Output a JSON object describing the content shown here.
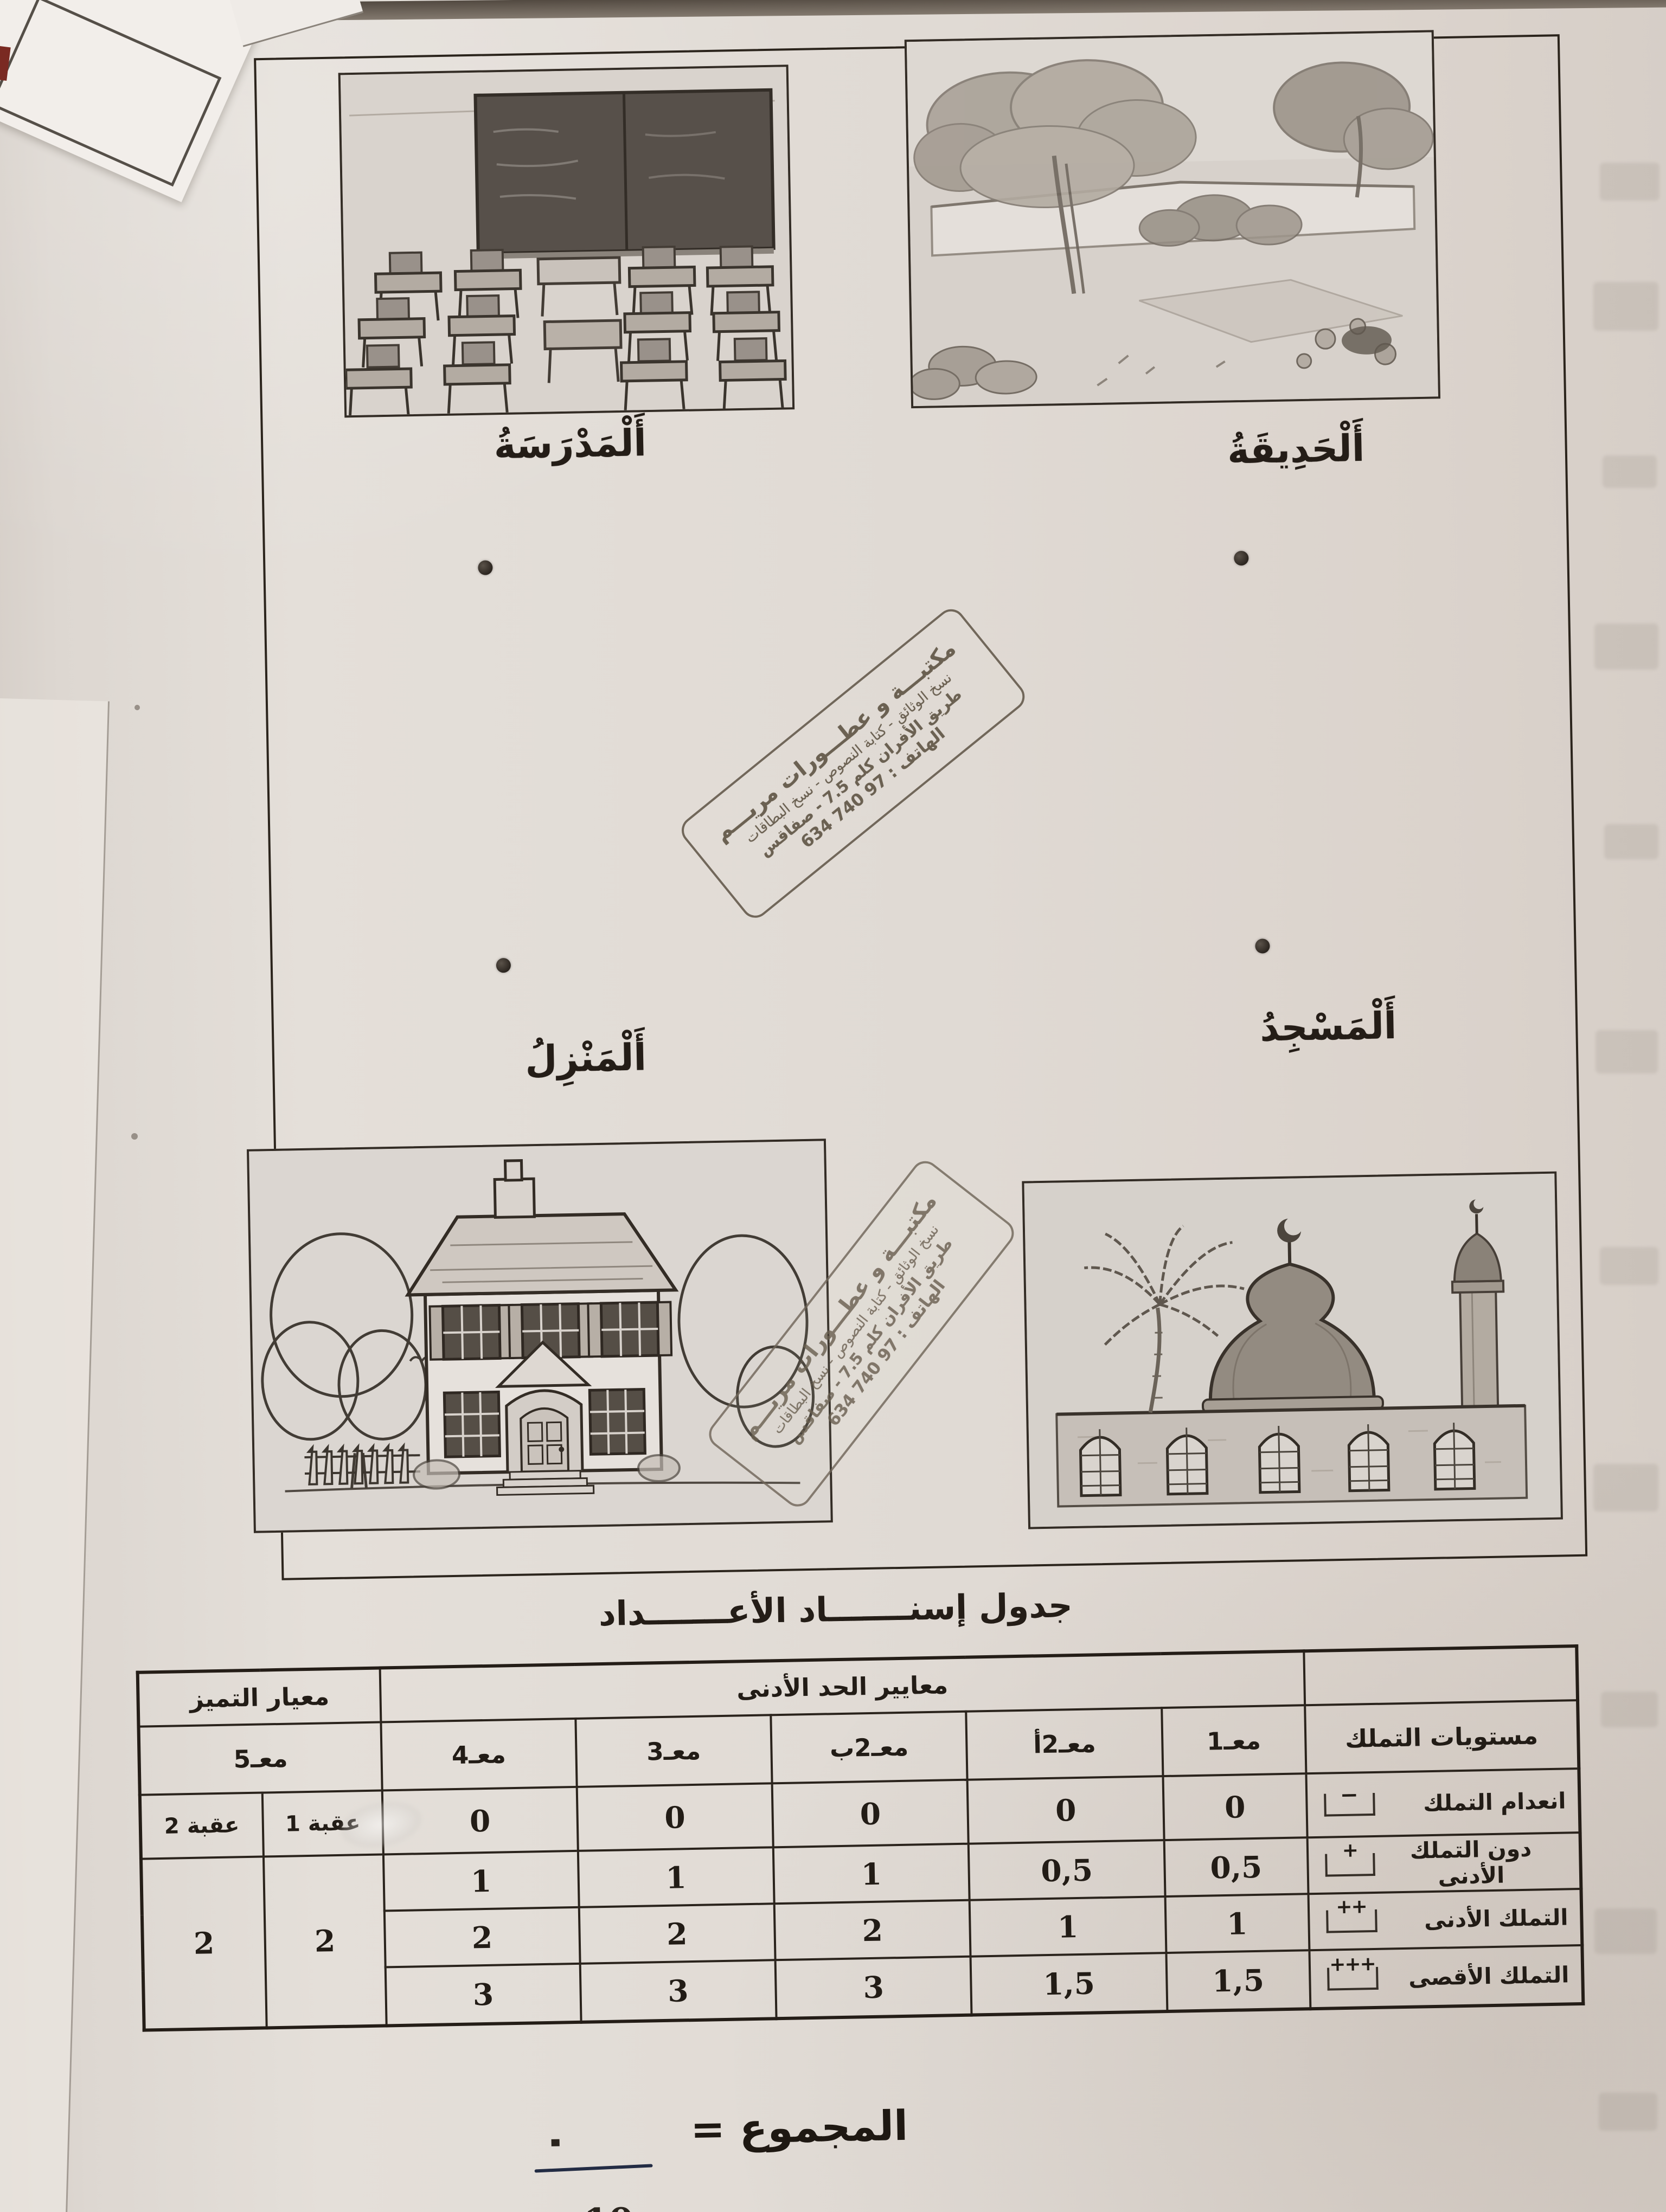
{
  "cards": {
    "school_label": "أَلْمَدْرَسَةُ",
    "garden_label": "أَلْحَدِيقَةُ",
    "house_label": "أَلْمَنْزِلُ",
    "mosque_label": "أَلْمَسْجِدُ"
  },
  "stamp": {
    "shop_name": "مكتبـــة و عطـــورات مريـــم",
    "services": "نسخ الوثائق - كتابة النصوص - نسخ البطاقات",
    "address": "طريق الأفران كلم 7.5 - صفاقس",
    "phone": "الهاتف : 97 740 634"
  },
  "section_title": "جدول إسنـــــــاد الأعـــــــداد",
  "table": {
    "min_criteria_header": "معايير الحد الأدنى",
    "excellence_header": "معيار التميز",
    "levels_header": "مستويات التملك",
    "col_m1": "معـ1",
    "col_m2a": "معـ2أ",
    "col_m2b": "معـ2ب",
    "col_m3": "معـ3",
    "col_m4": "معـ4",
    "col_m5": "معـ5",
    "col_obstacle1": "عقبة 1",
    "col_obstacle2": "عقبة 2",
    "rows": [
      {
        "label": "انعدام التملك",
        "symbol": "ــ",
        "v1": "0",
        "v2a": "0",
        "v2b": "0",
        "v3": "0",
        "v4": "0"
      },
      {
        "label": "دون التملك الأدنى",
        "symbol": "+",
        "v1": "0,5",
        "v2a": "0,5",
        "v2b": "1",
        "v3": "1",
        "v4": "1"
      },
      {
        "label": "التملك الأدنى",
        "symbol": "++",
        "v1": "1",
        "v2a": "1",
        "v2b": "2",
        "v3": "2",
        "v4": "2"
      },
      {
        "label": "التملك الأقصى",
        "symbol": "+++",
        "v1": "1,5",
        "v2a": "1,5",
        "v2b": "3",
        "v3": "3",
        "v4": "3"
      }
    ],
    "obstacle1_value": "2",
    "obstacle2_value": "2"
  },
  "total": {
    "label": "المجموع =",
    "numerator_mark": ".",
    "denominator": "10"
  }
}
